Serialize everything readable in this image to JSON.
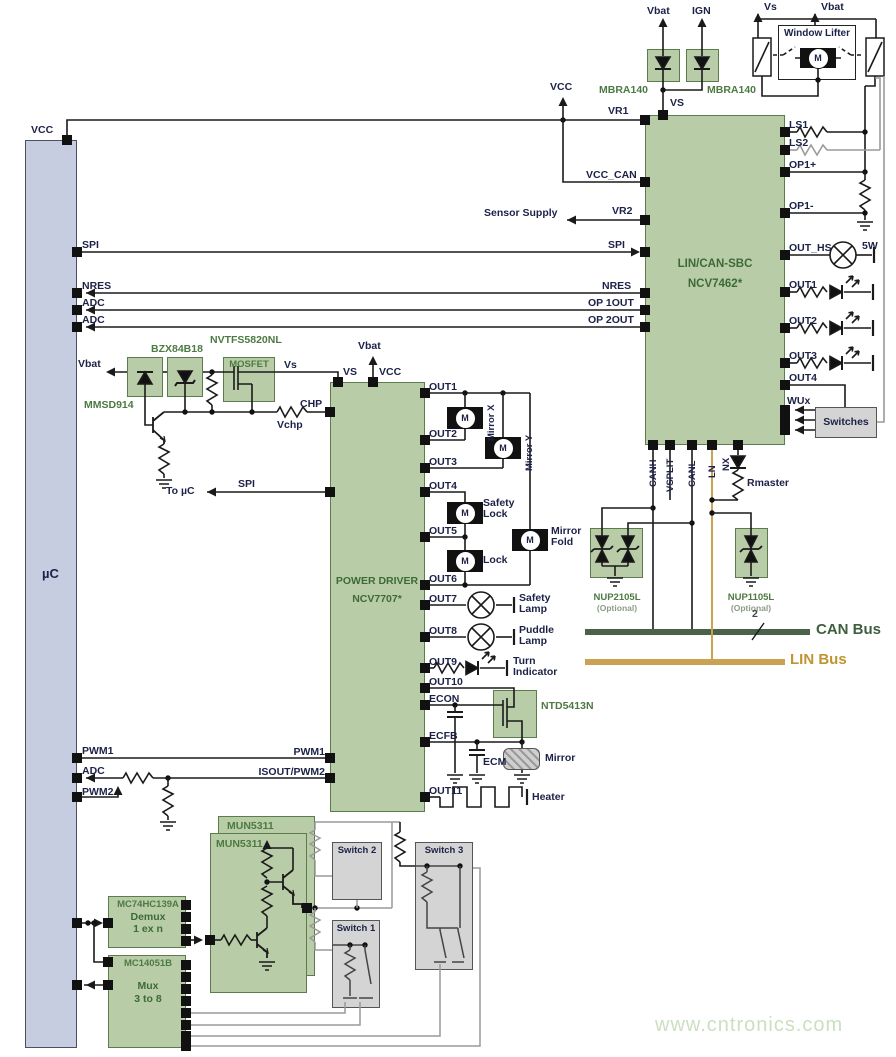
{
  "mcu": {
    "label": "µC",
    "vcc": "VCC",
    "spi": "SPI",
    "nres": "NRES",
    "adc1": "ADC",
    "adc2": "ADC",
    "pwm1": "PWM1",
    "adc3": "ADC",
    "pwm2": "PWM2"
  },
  "supply": {
    "vbat": "Vbat",
    "ign": "IGN",
    "mbra1": "MBRA140",
    "mbra2": "MBRA140",
    "vcc": "VCC",
    "vs": "VS"
  },
  "window": {
    "vs": "Vs",
    "vbat": "Vbat",
    "title": "Window Lifter",
    "motor": "M"
  },
  "sbc": {
    "title1": "LIN/CAN-SBC",
    "title2": "NCV7462*",
    "vr1": "VR1",
    "vcc_can": "VCC_CAN",
    "sensor": "Sensor Supply",
    "vr2": "VR2",
    "spi": "SPI",
    "nres": "NRES",
    "op1out": "OP 1OUT",
    "op2out": "OP 2OUT",
    "ls1": "LS1",
    "ls2": "LS2",
    "op1p": "OP1+",
    "op1m": "OP1-",
    "out_hs": "OUT_HS",
    "w5": "5W",
    "out1": "OUT1",
    "out2": "OUT2",
    "out3": "OUT3",
    "out4": "OUT4",
    "wux": "WUx",
    "canh": "CANH",
    "vsplit": "VSPLIT",
    "canl": "CANL",
    "ln": "LN",
    "nx": "NX",
    "rmaster": "Rmaster",
    "switches": "Switches"
  },
  "esd": {
    "nup2105l": "NUP2105L",
    "opt1": "(Optional)",
    "nup1105l": "NUP1105L",
    "opt2": "(Optional)",
    "pair": "2"
  },
  "bus": {
    "can": "CAN Bus",
    "lin": "LIN Bus"
  },
  "chp": {
    "vbat": "Vbat",
    "mmsd914": "MMSD914",
    "bzx": "BZX84B18",
    "nvtfs": "NVTFS5820NL",
    "mosfet": "MOSFET",
    "vs": "Vs",
    "chp": "CHP",
    "vchp": "Vchp",
    "to_uc": "To µC",
    "spi": "SPI"
  },
  "drv": {
    "title1": "POWER DRIVER",
    "title2": "NCV7707*",
    "vbat": "Vbat",
    "vs": "VS",
    "vcc": "VCC",
    "out1": "OUT1",
    "out2": "OUT2",
    "out3": "OUT3",
    "out4": "OUT4",
    "out5": "OUT5",
    "out6": "OUT6",
    "out7": "OUT7",
    "out8": "OUT8",
    "out9": "OUT9",
    "out10": "OUT10",
    "out11": "OUT11",
    "econ": "ECON",
    "ecfb": "ECFB",
    "pwm1": "PWM1",
    "isout": "ISOUT/PWM2"
  },
  "loads": {
    "mirror_x": "Mirror X",
    "mirror_y": "Mirror Y",
    "safety_lock": "Safety Lock",
    "lock": "Lock",
    "mirror_fold": "Mirror Fold",
    "safety_lamp": "Safety Lamp",
    "puddle_lamp": "Puddle Lamp",
    "turn_ind": "Turn Indicator",
    "ntd": "NTD5413N",
    "ecm": "ECM",
    "mirror": "Mirror",
    "heater": "Heater",
    "motor": "M"
  },
  "bottom": {
    "mun_a": "MUN5311",
    "mun_b": "MUN5311",
    "demux_part": "MC74HC139A",
    "demux1": "Demux",
    "demux2": "1 ex n",
    "mux_part": "MC14051B",
    "mux1": "Mux",
    "mux2": "3 to 8",
    "sw1": "Switch 1",
    "sw2": "Switch 2",
    "sw3": "Switch 3"
  },
  "watermark": "www.cntronics.com",
  "colors": {
    "block_fill": "#b9cca8",
    "block_border": "#5b7c4b",
    "mcu_fill": "#c7cde0",
    "part_text": "#4d7a42",
    "label_text": "#1c2247",
    "can_bus": "#4a614a",
    "lin_bus": "#c9a254",
    "gray_fill": "#d4d4d4",
    "wire": "#1a1a1a",
    "wire_gray": "#9a9a9a",
    "watermark": "#ccdfc0"
  }
}
